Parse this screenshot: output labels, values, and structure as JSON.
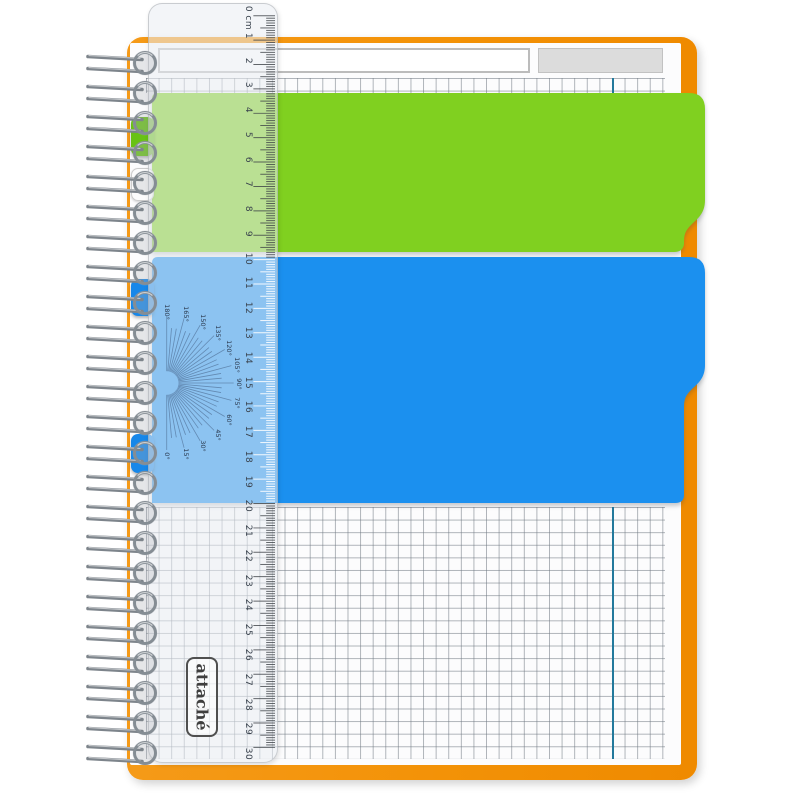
{
  "brand": {
    "logo_text": "attaché"
  },
  "ruler": {
    "unit": "cm",
    "labels": [
      "0 cm",
      "1",
      "2",
      "3",
      "4",
      "5",
      "6",
      "7",
      "8",
      "9",
      "10",
      "11",
      "12",
      "13",
      "14",
      "15",
      "16",
      "17",
      "18",
      "19",
      "20",
      "21",
      "22",
      "23",
      "24",
      "25",
      "26",
      "27",
      "28",
      "29",
      "30"
    ]
  },
  "protractor": {
    "labels": [
      "180°",
      "165°",
      "150°",
      "135°",
      "120°",
      "105°",
      "90°",
      "75°",
      "60°",
      "45°",
      "30°",
      "15°",
      "0°"
    ]
  },
  "header": {
    "title_field_value": "",
    "tag_field_value": ""
  },
  "colors": {
    "cover_orange": "#f39207",
    "divider_green": "#80d020",
    "divider_blue": "#1b90ef",
    "tab_green": "#68c214",
    "tab_blue": "#1787e9",
    "margin_line_teal": "#23799c",
    "grid_line_gray": "#6d7680",
    "spiral_metal": "#858d94"
  },
  "notebook": {
    "spiral_loop_count": 24,
    "left_tabs": [
      {
        "id": "tab-green",
        "color": "green"
      },
      {
        "id": "tab-clear",
        "color": "clear"
      },
      {
        "id": "tab-blue-1",
        "color": "blue"
      },
      {
        "id": "tab-blue-2",
        "color": "blue"
      }
    ]
  }
}
